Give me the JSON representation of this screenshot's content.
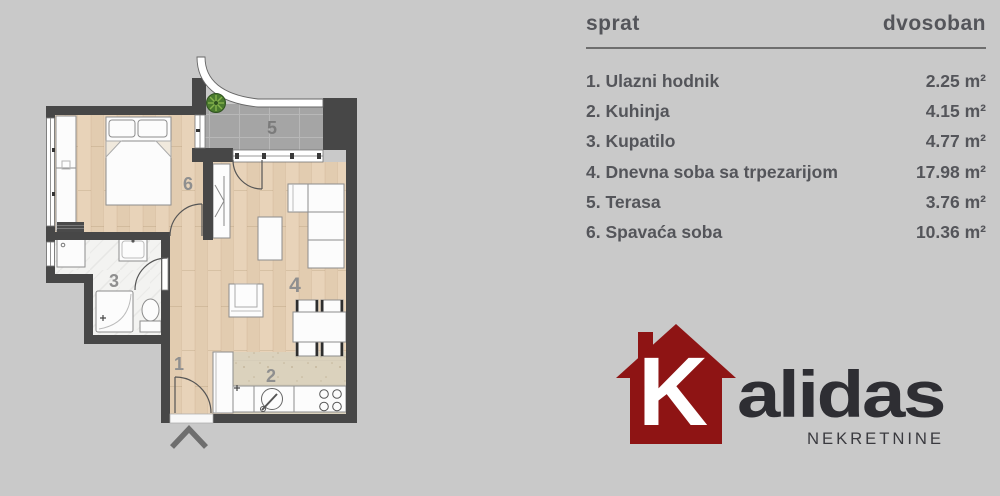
{
  "background_color": "#c9c9c9",
  "panel": {
    "header_left": "sprat",
    "header_right": "dvosoban",
    "rooms": [
      {
        "label": "1. Ulazni hodnik",
        "area": "2.25 m²"
      },
      {
        "label": "2. Kuhinja",
        "area": "4.15 m²"
      },
      {
        "label": "3. Kupatilo",
        "area": "4.77 m²"
      },
      {
        "label": "4. Dnevna soba sa trpezarijom",
        "area": "17.98 m²"
      },
      {
        "label": "5. Terasa",
        "area": "3.76 m²"
      },
      {
        "label": "6. Spavaća soba",
        "area": "10.36 m²"
      }
    ]
  },
  "floor_plan": {
    "room_numbers": [
      "1",
      "2",
      "3",
      "4",
      "5",
      "6"
    ]
  },
  "logo": {
    "initial": "K",
    "name_rest": "alidas",
    "subtitle": "NEKRETNINE",
    "house_color": "#8e1414",
    "text_color": "#2e2e33"
  }
}
